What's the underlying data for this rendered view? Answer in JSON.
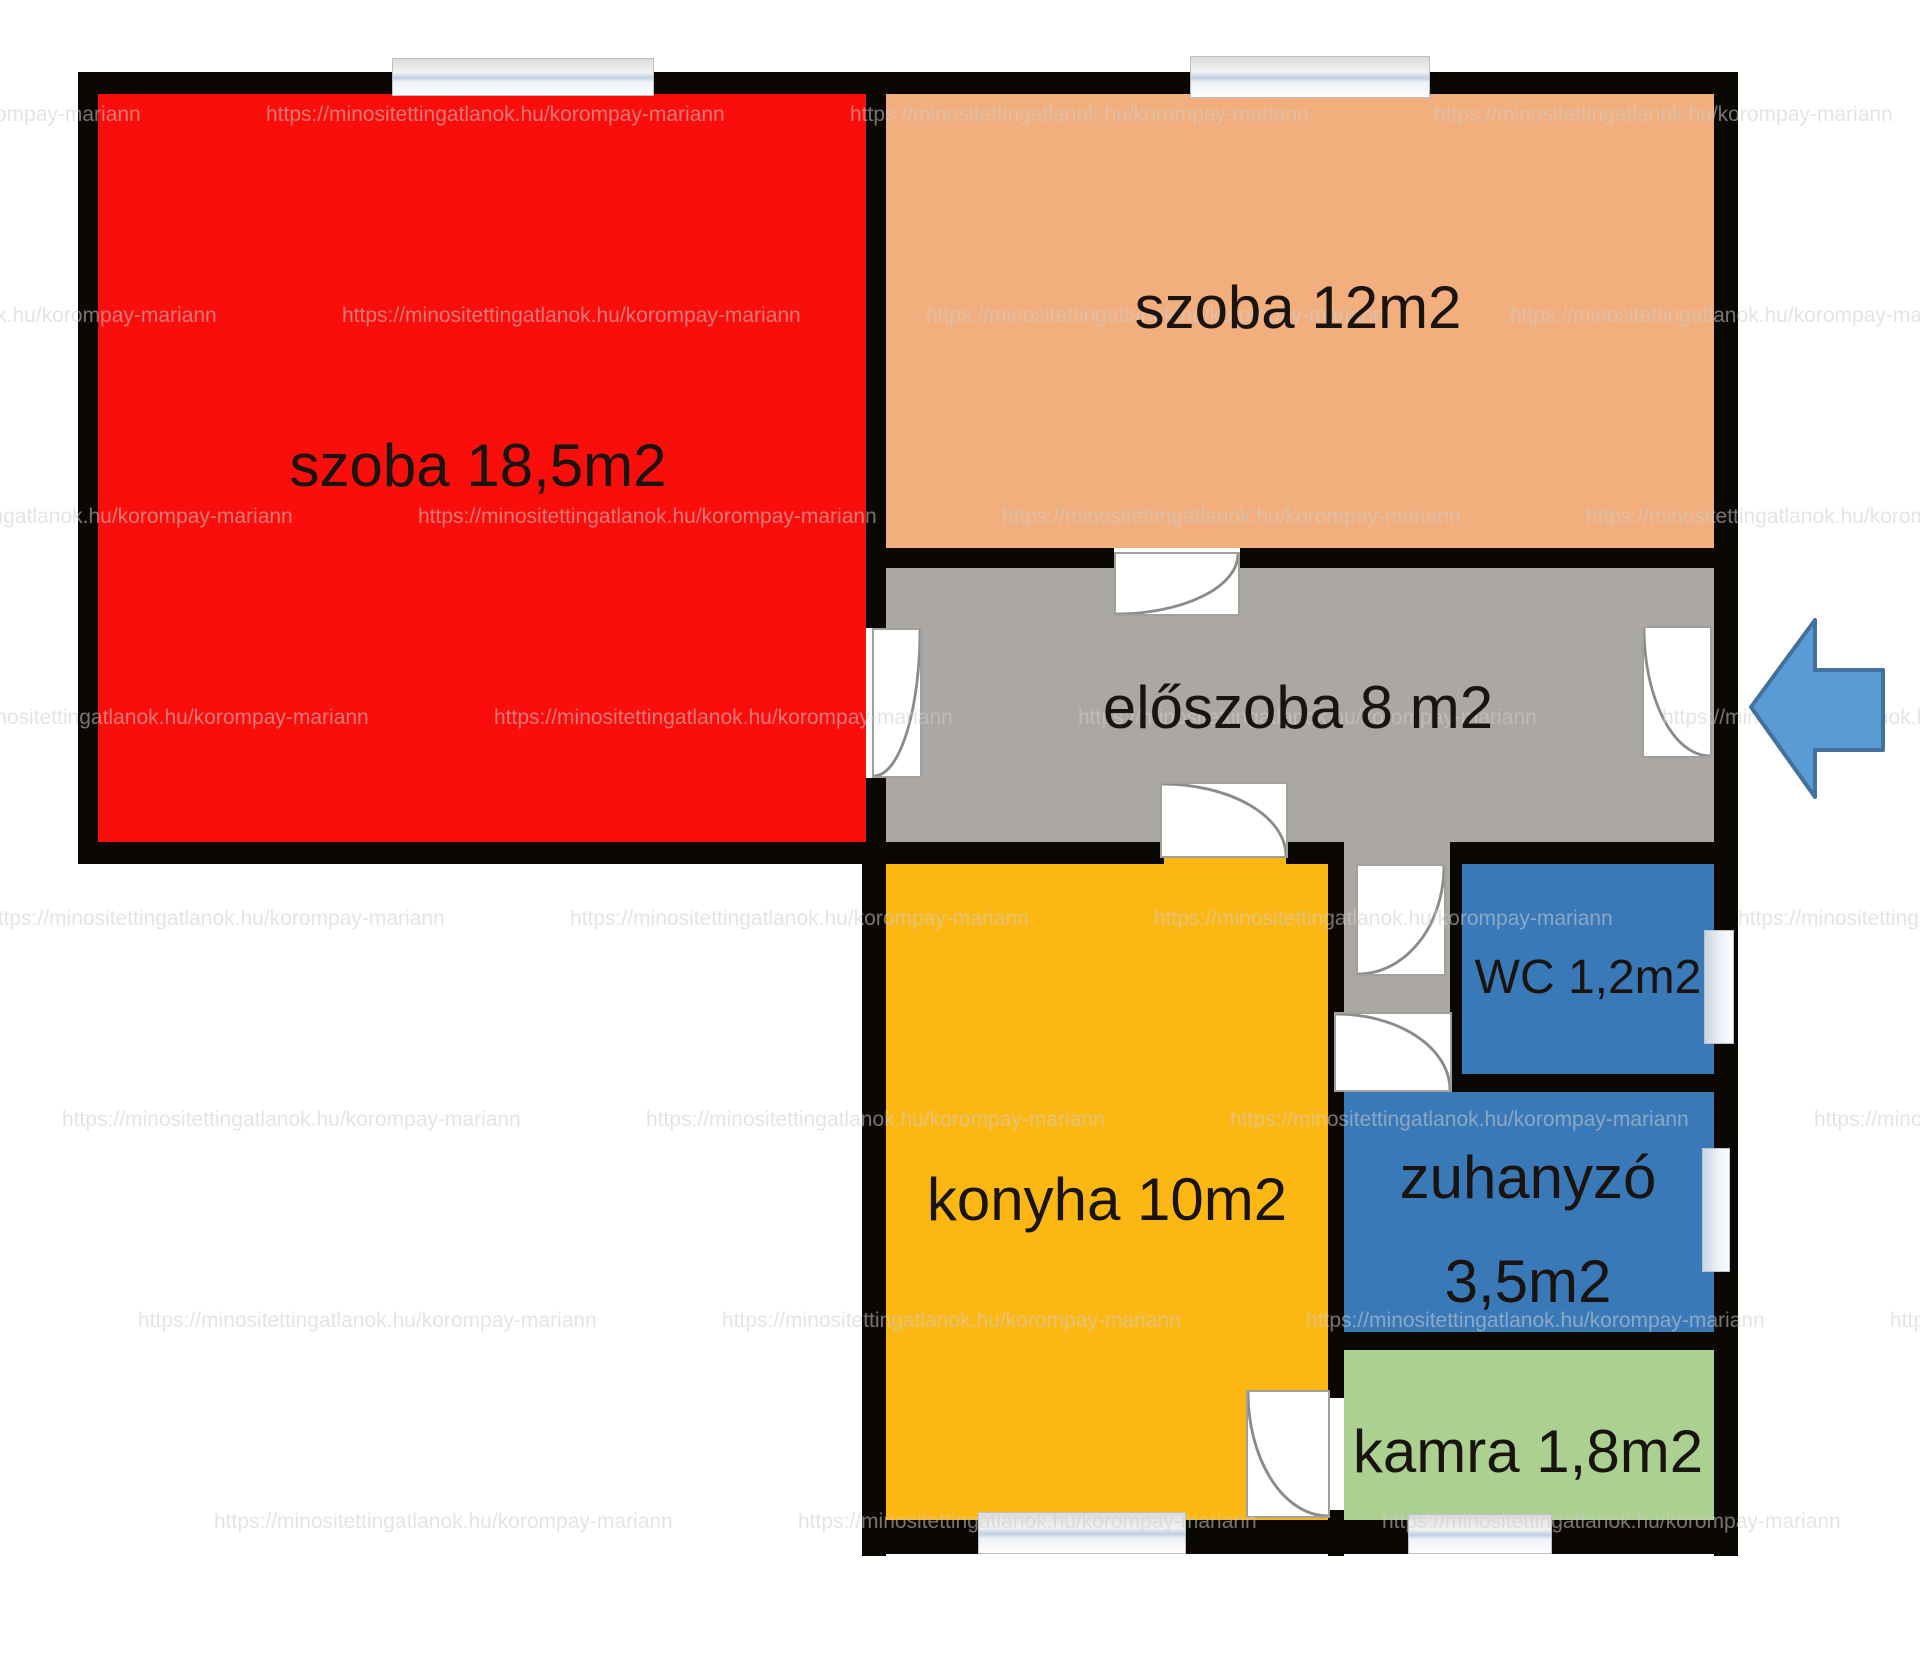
{
  "floorplan": {
    "title": "apartment floor plan",
    "watermark_text": "https://minositettingatlanok.hu/korompay-mariann",
    "rooms": [
      {
        "name": "szoba-large",
        "label": "szoba 18,5m2",
        "color": "#fa0e0b"
      },
      {
        "name": "szoba-small",
        "label": "szoba 12m2",
        "color": "#f2ae7d"
      },
      {
        "name": "eloszoba",
        "label": "előszoba 8 m2",
        "color": "#aba7a3"
      },
      {
        "name": "konyha",
        "label": "konyha 10m2",
        "color": "#fcb713"
      },
      {
        "name": "wc",
        "label": "WC 1,2m2",
        "color": "#3a79b8"
      },
      {
        "name": "zuhanyzo",
        "label": "zuhanyzó",
        "label2": "3,5m2",
        "color": "#3a79b8"
      },
      {
        "name": "kamra",
        "label": "kamra 1,8m2",
        "color": "#abd08f"
      }
    ],
    "entrance_arrow": {
      "direction": "left",
      "fill": "#5b9bd5",
      "stroke": "#41719c"
    },
    "colors": {
      "wall": "#0b0804",
      "label_text": "#19140f",
      "corridor": "#aba7a3"
    }
  }
}
